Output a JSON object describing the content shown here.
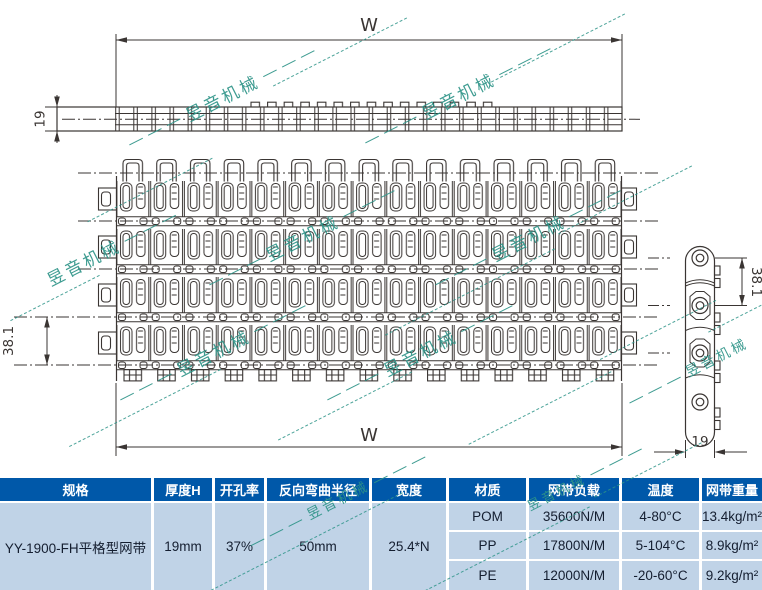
{
  "watermark": {
    "text": "昱音机械",
    "dashes": "— — —",
    "color": "#2e9488"
  },
  "drawing": {
    "width_top": "W",
    "width_bottom": "W",
    "thickness": "19",
    "pitch_plan": "38.1",
    "pitch_side": "38.1",
    "side_width": "19",
    "line_color": "#3a3533"
  },
  "table": {
    "header_bg": "#0058a9",
    "row_bg": "#c0d3e7",
    "headers": [
      "规格",
      "厚度H",
      "开孔率",
      "反向弯曲半径",
      "宽度",
      "材质",
      "网带负载",
      "温度",
      "网带重量"
    ],
    "spec": "YY-1900-FH平格型网带",
    "thickness": "19mm",
    "open_ratio": "37%",
    "bend_radius": "50mm",
    "width": "25.4*N",
    "materials": [
      {
        "material": "POM",
        "load": "35600N/M",
        "temp": "4-80°C",
        "weight": "13.4kg/m²"
      },
      {
        "material": "PP",
        "load": "17800N/M",
        "temp": "5-104°C",
        "weight": "8.9kg/m²"
      },
      {
        "material": "PE",
        "load": "12000N/M",
        "temp": "-20-60°C",
        "weight": "9.2kg/m²"
      }
    ]
  }
}
